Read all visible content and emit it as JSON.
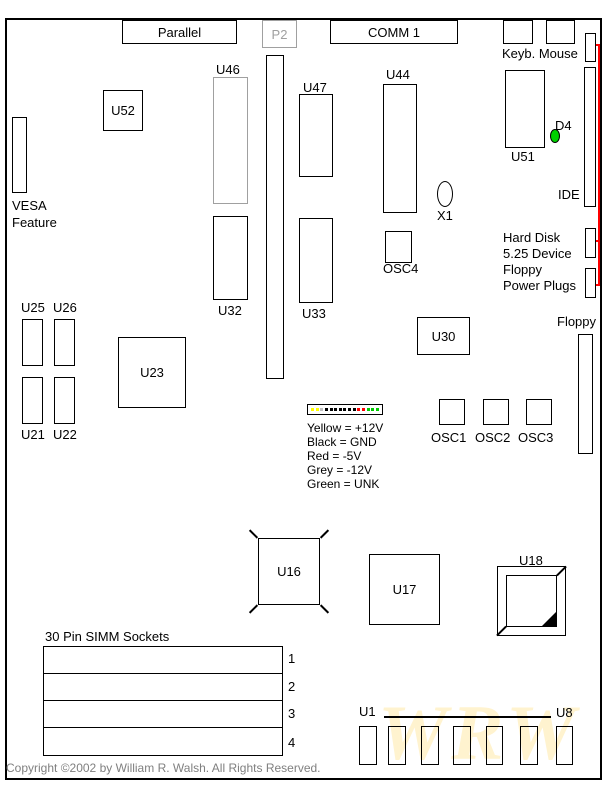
{
  "top_edge": {
    "parallel": "Parallel",
    "p2": "P2",
    "comm1": "COMM 1",
    "keyb_mouse": "Keyb. Mouse"
  },
  "left_side": {
    "vesa": [
      "VESA",
      "Feature"
    ]
  },
  "right_side": {
    "ide": "IDE",
    "power_caption": [
      "Hard Disk",
      "5.25 Device",
      "Floppy",
      "Power Plugs"
    ],
    "floppy": "Floppy",
    "d4": "D4"
  },
  "chips": {
    "u52": "U52",
    "u46": "U46",
    "u47": "U47",
    "u44": "U44",
    "u51": "U51",
    "u32": "U32",
    "u33": "U33",
    "u30": "U30",
    "u23": "U23",
    "u25": "U25",
    "u26": "U26",
    "u21": "U21",
    "u22": "U22",
    "u16": "U16",
    "u17": "U17",
    "u18": "U18",
    "u1": "U1",
    "u8": "U8"
  },
  "oscillators": {
    "osc1": "OSC1",
    "osc2": "OSC2",
    "osc3": "OSC3",
    "osc4": "OSC4",
    "x1": "X1"
  },
  "power_legend": {
    "lines": [
      "Yellow = +12V",
      "Black = GND",
      "Red = -5V",
      "Grey = -12V",
      "Green = UNK"
    ],
    "pin_colors": [
      "#ffff00",
      "#ffff00",
      "#c0c0c0",
      "#000000",
      "#000000",
      "#000000",
      "#000000",
      "#000000",
      "#000000",
      "#000000",
      "#ff0000",
      "#ff0000",
      "#00cc00",
      "#00cc00",
      "#00cc00"
    ]
  },
  "simm": {
    "title": "30 Pin SIMM Sockets",
    "slots": [
      "1",
      "2",
      "3",
      "4"
    ]
  },
  "footer": {
    "copyright": "Copyright ©2002 by William R. Walsh. All Rights Reserved.",
    "watermark": "WRW"
  },
  "colors": {
    "highlight_line": "#ff0000",
    "led_green": "#00d000",
    "gray_outline": "#a0a0a0",
    "copyright_gray": "#808080",
    "watermark_yellow": "#fff3cf"
  }
}
